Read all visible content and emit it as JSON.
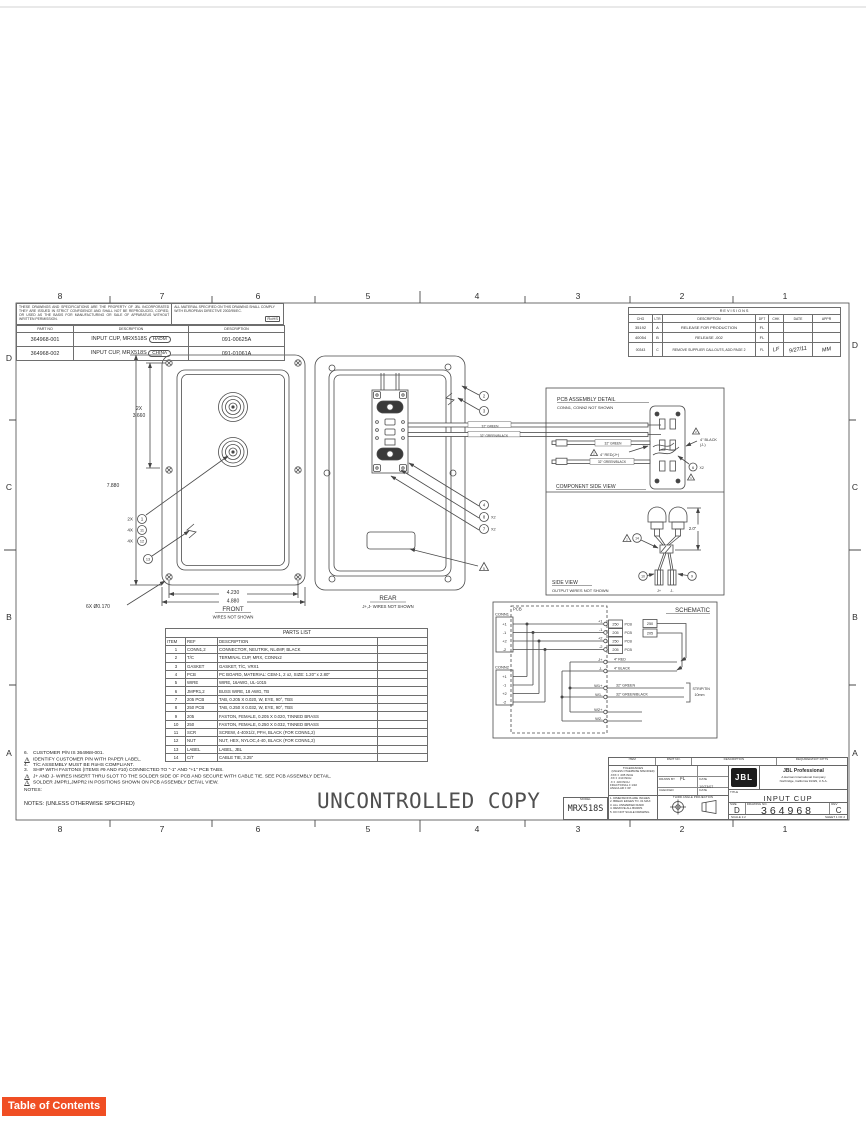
{
  "page": {
    "toc_label": "Table of Contents",
    "watermark": "UNCONTROLLED COPY"
  },
  "border": {
    "cols": [
      "8",
      "7",
      "6",
      "5",
      "4",
      "3",
      "2",
      "1"
    ],
    "rows": [
      "D",
      "C",
      "B",
      "A"
    ]
  },
  "property_note": "THESE DRAWINGS AND SPECIFICATIONS ARE THE PROPERTY OF JBL INCORPORATED THEY ARE ISSUED IN STRICT CONFIDENCE AND SHALL NOT BE REPRODUCED, COPIED, OR USED AS THE BASIS FOR MANUFACTURING OR SALE OF APPARATUS WITHOUT WRITTEN PERMISSION.",
  "material_note": "ALL MATERIAL SPECIFIED ON THIS DRAWING SHALL COMPLY WITH EUROPEAN DIRECTIVE 2002/95/EC.",
  "rohs": "RoHS",
  "part_table": {
    "headers": [
      "PART NO",
      "DESCRIPTION",
      "DESCRIPTION"
    ],
    "rows": [
      {
        "part": "364968-001",
        "desc": "INPUT CUP, MRX518S",
        "origin": "HADM",
        "doc": "091-00625A"
      },
      {
        "part": "364968-002",
        "desc": "INPUT CUP, MRX518S",
        "origin": "CHINA",
        "doc": "091-01061A"
      }
    ]
  },
  "revisions": {
    "title": "REVISIONS",
    "headers": [
      "CHG",
      "LTR",
      "DESCRIPTION",
      "DFT",
      "CHK",
      "DATE",
      "APPR"
    ],
    "rows": [
      {
        "chg": "35192",
        "ltr": "A",
        "desc": "RELEASE FOR PRODUCTION",
        "dft": "FL",
        "chk": "",
        "date": "",
        "appr": ""
      },
      {
        "chg": "40054",
        "ltr": "B",
        "desc": "RELEASE  -002",
        "dft": "FL",
        "chk": "",
        "date": "",
        "appr": ""
      },
      {
        "chg": "00343",
        "ltr": "C",
        "desc": "REMOVE SUPPLIER CALLOUTS, ADD PAGE 2",
        "dft": "FL",
        "chk": "LF",
        "date": "9/27/11",
        "appr": "MM"
      }
    ]
  },
  "front": {
    "qty_1": "2X",
    "b1": "1",
    "qty_11": "4X",
    "b11": "11",
    "qty_12": "4X",
    "b12": "12",
    "b13": "13",
    "dim_2x": "2X",
    "dim_3660": "3.660",
    "dim_7880": "7.880",
    "dim_4230": "4.230",
    "dim_4880": "4.880",
    "hole_note": "6X Ø0.170",
    "caption": "FRONT",
    "subcaption": "WIRES NOT SHOWN"
  },
  "rear": {
    "b2": "2",
    "b3": "3",
    "b4": "4",
    "b8": "8",
    "b8x": "X2",
    "b7": "7",
    "b7x": "X2",
    "tri5": "5",
    "wire1": "32\" GREEN",
    "wire2": "32\" GREEN/BLACK",
    "caption": "REAR",
    "subcaption": "J+,J- WIRES NOT SHOWN"
  },
  "pcb_detail": {
    "title": "PCB ASSEMBLY DETAIL",
    "subtitle": "CONN1, CONN2 NOT SHOWN",
    "wire_green": "32\" GREEN",
    "red_label": "4\" RED(J+)",
    "wire_gb": "32\" GREEN/BLACK",
    "black_label": "4\" BLACK",
    "black_label2": "(J-)",
    "tri2a": "2",
    "tri2b": "2",
    "b6": "6",
    "b6x": "X2",
    "tri1": "1",
    "caption": "COMPONENT SIDE VIEW"
  },
  "side": {
    "dim": "2.0\"",
    "tri2": "2",
    "b14": "14",
    "b10": "10",
    "b9": "9",
    "jp": "J+",
    "jm": "J-",
    "caption": "SIDE VIEW",
    "subcaption": "OUTPUT WIRES NOT SHOWN"
  },
  "schem": {
    "title": "SCHEMATIC",
    "pcb": "PCB",
    "conn1": "CONN1",
    "conn2": "CONN2",
    "pins": [
      "+1",
      "-1",
      "+2",
      "-2"
    ],
    "tabs": [
      {
        "pin": "+1",
        "size": "250"
      },
      {
        "pin": "-1",
        "size": "205"
      },
      {
        "pin": "+2",
        "size": "250"
      },
      {
        "pin": "-2",
        "size": "205"
      }
    ],
    "pcb_suffix": "PCB",
    "loose": [
      "250",
      "205"
    ],
    "j1": "J+",
    "j1w": "4\" RED",
    "j2": "J-",
    "j2w": "4\" BLACK",
    "w1p": "W1+",
    "w1pw": "32\" GREEN",
    "w1m": "W1-",
    "w1mw": "32\" GREEN/BLACK",
    "w2p": "W2+",
    "w2m": "W2-",
    "strip": "STRIP/TIN",
    "strip2": "10mm"
  },
  "parts_list": {
    "title": "PARTS LIST",
    "headers": [
      "ITEM",
      "REF",
      "DESCRIPTION"
    ],
    "rows": [
      {
        "item": "1",
        "ref": "CONN1,2",
        "desc": "CONNECTOR, NEUTRIK, NL4MP, BLACK"
      },
      {
        "item": "2",
        "ref": "T/C",
        "desc": "TERMINAL CUP, MRX, CONNx2"
      },
      {
        "item": "3",
        "ref": "GASKET",
        "desc": "GASKET,  T/C, VRX1"
      },
      {
        "item": "4",
        "ref": "PCB",
        "desc": "PC BOARD, MATERIAL: CEM-1, 2 oz, SIZE: 1.20\" x 2.80\""
      },
      {
        "item": "5",
        "ref": "WIRE",
        "desc": "WIRE, 16AWG, UL-1015"
      },
      {
        "item": "6",
        "ref": "JMPR1,2",
        "desc": "BUSS WIRE, 18 AWG, TB"
      },
      {
        "item": "7",
        "ref": "205 PCB",
        "desc": "TAB, 0.205 X 0.020, W, EYE, 90°, TBS"
      },
      {
        "item": "8",
        "ref": "250 PCB",
        "desc": "TAB, 0.250 X 0.032, W, EYE, 90°, TBS"
      },
      {
        "item": "9",
        "ref": "205",
        "desc": "FASTON, FEMALE, 0.205 X 0.020, TINNED BRASS"
      },
      {
        "item": "10",
        "ref": "250",
        "desc": "FASTON, FEMALE, 0.250 X 0.032, TINNED BRASS"
      },
      {
        "item": "11",
        "ref": "SCR",
        "desc": "SCREW, 4-40X1/2, PFH, BLACK (FOR CONN1,2)"
      },
      {
        "item": "12",
        "ref": "NUT",
        "desc": "NUT, HEX, NYLOC,4-40, BLACK (FOR CONN1,2)"
      },
      {
        "item": "13",
        "ref": "LABEL",
        "desc": "LABEL, JBL"
      },
      {
        "item": "14",
        "ref": "C/T",
        "desc": "CABLE TIE, 3.25\""
      }
    ]
  },
  "notes": {
    "lines": [
      {
        "marker": "6.",
        "text": "CUSTOMER P/N IS 364968-001."
      },
      {
        "marker": "5",
        "text": "IDENTIFY CUSTOMER P/N WITH PAPER LABEL."
      },
      {
        "marker": "4.",
        "text": "T/C ASSEMBLY MUST BE RoHS COMPLIANT."
      },
      {
        "marker": "3.",
        "text": "SHIP WITH FASTONS (ITEMS #9 AND #10) CONNECTED TO \"-1\" AND \"+1\" PCB TABS."
      },
      {
        "marker": "2",
        "text": "J+ AND J- WIRES INSERT THRU SLOT TO THE SOLDER SIDE OF PCB  AND SECURE WITH CABLE TIE.  SEE PCB ASSEMBLY DETAIL."
      },
      {
        "marker": "1",
        "text": "SOLDER JMPR1,JMPR2 IN POSITIONS SHOWN ON PCB ASSEMBLY DETAIL VIEW."
      }
    ],
    "label": "NOTES:",
    "footer": "NOTES: (UNLESS OTHERWISE SPECIFIED)"
  },
  "title_block": {
    "header": [
      "ITEM",
      "PART NO.",
      "DESCRIPTION",
      "REQUIRED/NOT F/PTS"
    ],
    "tol_title": "TOLERANCES",
    "tol_sub": "(UNLESS OTHERWISE SPECIFIED)",
    "tol_lines": [
      ".XXX  ± .005 INCH",
      ".XX   ± .010 INCH",
      ".X    ± .020 INCH",
      "FRACTIONAL ± 1/32",
      "ANGULAR ± 30'"
    ],
    "std_notes": [
      "1. DIMENSIONS ARE INCHES",
      "2. BREAK EDGES TO .01 MAX",
      "3. ALL UNMARKED RADII",
      "4. REMOVE ALL BURRS",
      "5. DO NOT SCALE DRAWING"
    ],
    "drawn_by_label": "DRAWN BY",
    "drawn_by": "FL",
    "checked_label": "CHECKED",
    "approved_label": "APPROVED",
    "date_label": "DATE",
    "date": "10/23/07",
    "third_angle": "THIRD ANGLE PROJECTION",
    "logo": "JBL",
    "company": "JBL Professional",
    "company2": "A Harman International Company",
    "company3": "Northridge, California 91329, U.S.A.",
    "title_label": "TITLE",
    "title": "INPUT CUP",
    "size_label": "SIZE",
    "size": "D",
    "dwg_label": "DRAWING NO.",
    "drawing_no": "364968",
    "rev_label": "REV",
    "rev": "C",
    "scale": "SCALE  1:2",
    "sheet": "SHEET  1  OF  2",
    "model_label": "MODEL",
    "model": "MRX518S"
  }
}
